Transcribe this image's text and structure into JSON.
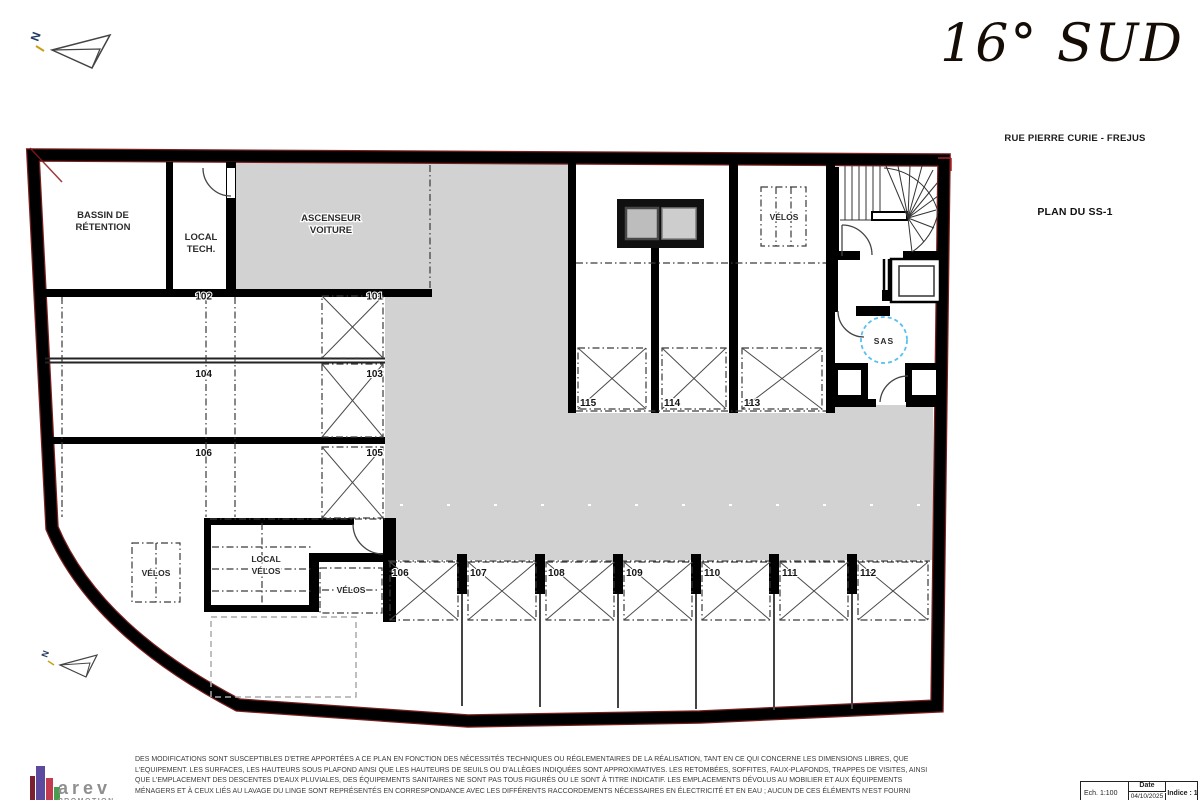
{
  "page": {
    "title_logo": "16° SUD",
    "address": "RUE PIERRE CURIE - FREJUS",
    "plan_title": "PLAN DU SS-1"
  },
  "north": {
    "label": "N"
  },
  "plan": {
    "rooms": {
      "bassin": [
        "BASSIN DE",
        "RÉTENTION"
      ],
      "local_tech": [
        "LOCAL",
        "TECH."
      ],
      "ascenseur": [
        "ASCENSEUR",
        "VOITURE"
      ],
      "velos_top": "VÉLOS",
      "velos_left": "VÉLOS",
      "velos_mid": "VÉLOS",
      "local_velos": [
        "LOCAL",
        "VÉLOS"
      ],
      "sas": "SAS"
    },
    "parking_left_rows": [
      {
        "left": "102",
        "right": "101"
      },
      {
        "left": "104",
        "right": "103"
      },
      {
        "left": "106",
        "right": "105"
      }
    ],
    "parking_mid_row": [
      "115",
      "114",
      "113"
    ],
    "parking_bottom_row": [
      "106",
      "107",
      "108",
      "109",
      "110",
      "111",
      "112"
    ],
    "colors": {
      "aisle_gray": "#d2d2d2",
      "sas_blue": "#58c0ef",
      "wall_black": "#000000",
      "red_accent": "#7a1f1f"
    }
  },
  "footer": {
    "logo": {
      "name": "arev",
      "sub": "PROMOTION"
    },
    "disclaimer": [
      "DES MODIFICATIONS SONT SUSCEPTIBLES D'ETRE APPORTÉES A CE PLAN EN FONCTION DES NÉCESSITÉS TECHNIQUES OU RÉGLEMENTAIRES DE LA RÉALISATION, TANT EN CE QUI CONCERNE LES DIMENSIONS LIBRES, QUE",
      "L'EQUIPEMENT. LES SURFACES, LES HAUTEURS SOUS PLAFOND AINSI QUE LES HAUTEURS DE SEUILS OU D'ALLÈGES INDIQUÉES SONT APPROXIMATIVES. LES RETOMBÉES, SOFFITES, FAUX-PLAFONDS, TRAPPES DE VISITES, AINSI",
      "QUE L'EMPLACEMENT DES DESCENTES D'EAUX PLUVIALES, DES ÉQUIPEMENTS SANITAIRES NE SONT PAS TOUS FIGURÉS OU LE SONT À TITRE INDICATIF. LES EMPLACEMENTS DÉVOLUS AU MOBILIER ET AUX ÉQUIPEMENTS",
      "MÉNAGERS ET À CEUX LIÉS AU LAVAGE DU LINGE SONT REPRÉSENTÉS EN CORRESPONDANCE AVEC LES DIFFÉRENTS RACCORDEMENTS NÉCESSAIRES EN ÉLECTRICITÉ ET EN EAU ; AUCUN DE CES ÉLÉMENTS N'EST FOURNI",
      ""
    ],
    "titleblock": {
      "scale": "Ech. 1:100",
      "date_label": "Date",
      "date_value": "04/10/2025",
      "indice": "Indice : 1"
    }
  }
}
